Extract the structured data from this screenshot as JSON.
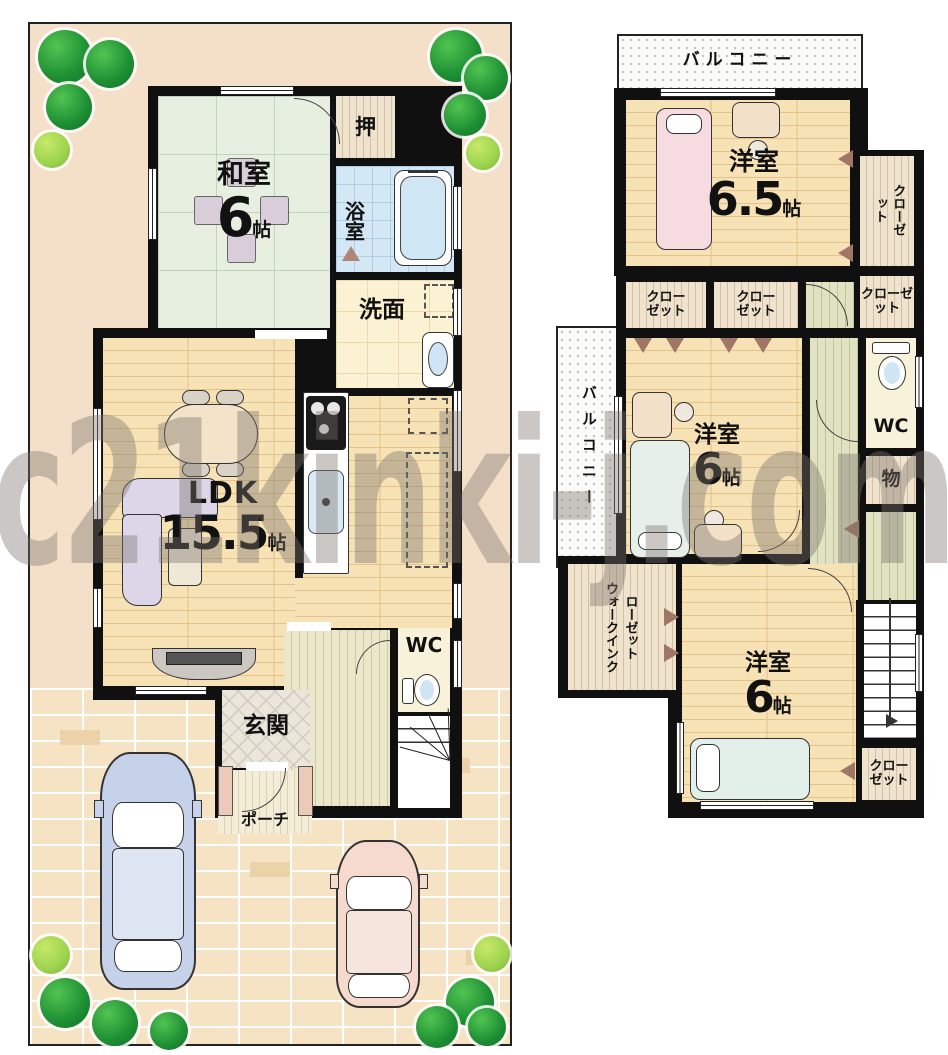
{
  "watermark": "c21kinki-j.com",
  "floor1": {
    "washitsu": {
      "name": "和室",
      "num": "6",
      "unit": "帖"
    },
    "oshiire": "押",
    "bath": "浴室",
    "senmen": "洗面",
    "ldk": {
      "name": "LDK",
      "num": "15.5",
      "unit": "帖"
    },
    "wc": "WC",
    "genkan": "玄関",
    "porch": "ポーチ"
  },
  "floor2": {
    "balcony_top": "バルコニー",
    "balcony_left": "バルコニー",
    "room65": {
      "name": "洋室",
      "num": "6.5",
      "unit": "帖"
    },
    "room6mid": {
      "name": "洋室",
      "num": "6",
      "unit": "帖"
    },
    "room6btm": {
      "name": "洋室",
      "num": "6",
      "unit": "帖"
    },
    "closet_tall": "クローゼット",
    "closet_small": "クローゼット",
    "closet_a": "クローゼット",
    "closet_b": "クローゼット",
    "closet_stairs": "クローゼット",
    "wic": "ウォークインクローゼット",
    "wc": "WC",
    "storage": "物"
  },
  "colors": {
    "wall": "#101010",
    "lot": "#f4dfc8",
    "wood_floor": "#f7e2b6",
    "tatami": "#e7efe0",
    "bath_tile": "#d4e7f5",
    "brick": "#f5e3c3",
    "car_blue": "#c6d2ea",
    "car_pink": "#f6dacd",
    "tree_green": "#1d8f33",
    "watermark_gray": "rgba(122,116,108,0.40)"
  }
}
